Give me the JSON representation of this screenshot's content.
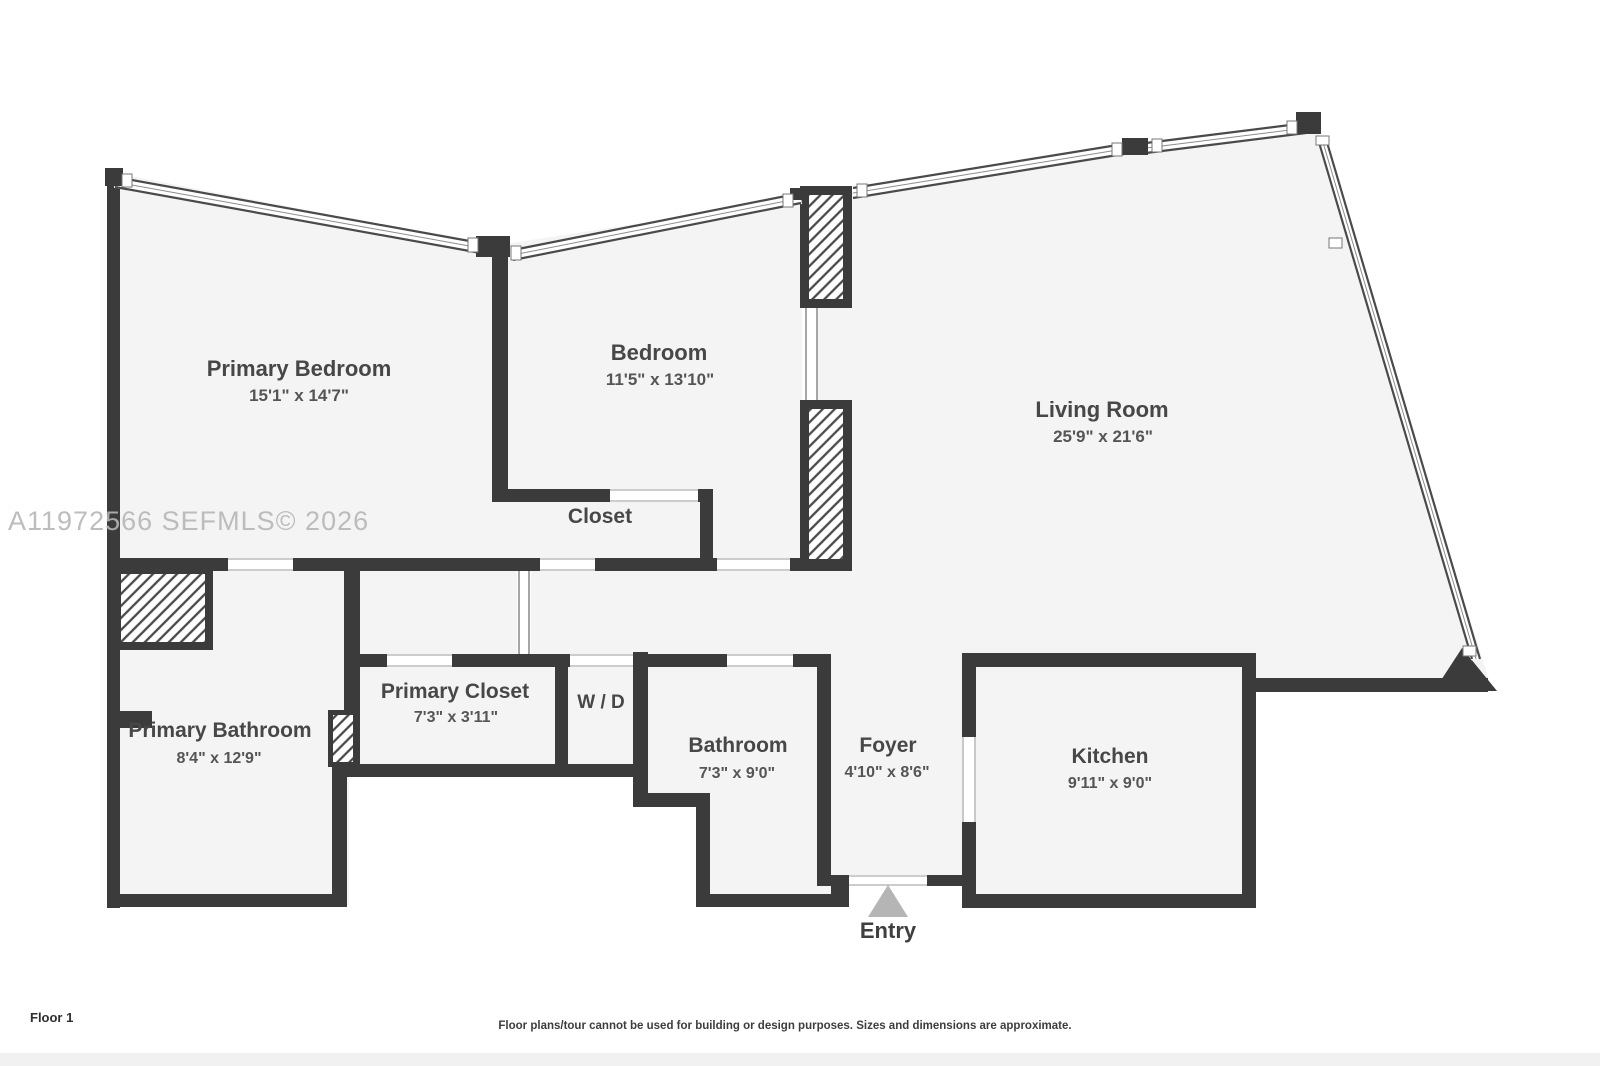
{
  "watermark": "A11972566 SEFMLS© 2026",
  "footer": {
    "floor_label": "Floor 1",
    "disclaimer": "Floor plans/tour cannot be used for building or design purposes. Sizes and dimensions are approximate."
  },
  "entry": {
    "label": "Entry",
    "icon": "entry-arrow-icon"
  },
  "colors": {
    "wall": "#3b3b3b",
    "floor": "#f4f4f4",
    "background": "#ffffff",
    "watermark": "#b6b6b6",
    "entry_arrow": "#b5b5b5"
  },
  "rooms": {
    "primary_bedroom": {
      "name": "Primary Bedroom",
      "dims": "15'1\" x 14'7\""
    },
    "bedroom": {
      "name": "Bedroom",
      "dims": "11'5\" x 13'10\""
    },
    "living_room": {
      "name": "Living Room",
      "dims": "25'9\" x 21'6\""
    },
    "closet": {
      "name": "Closet"
    },
    "primary_closet": {
      "name": "Primary Closet",
      "dims": "7'3\" x 3'11\""
    },
    "washer_dryer": {
      "name": "W / D"
    },
    "bathroom": {
      "name": "Bathroom",
      "dims": "7'3\" x 9'0\""
    },
    "foyer": {
      "name": "Foyer",
      "dims": "4'10\" x 8'6\""
    },
    "kitchen": {
      "name": "Kitchen",
      "dims": "9'11\" x 9'0\""
    },
    "primary_bathroom": {
      "name": "Primary Bathroom",
      "dims": "8'4\" x 12'9\""
    }
  }
}
